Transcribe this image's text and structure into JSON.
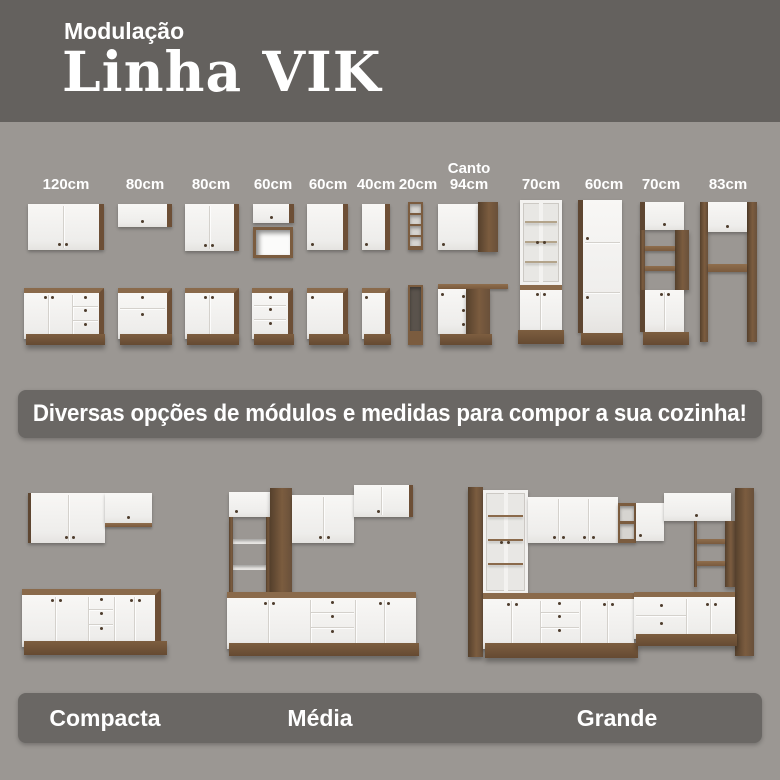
{
  "header": {
    "kicker": "Modulação",
    "title": "Linha VIK"
  },
  "modules": {
    "labels": [
      "120cm",
      "80cm",
      "80cm",
      "60cm",
      "60cm",
      "40cm",
      "20cm",
      "Canto 94cm",
      "70cm",
      "60cm",
      "70cm",
      "83cm"
    ]
  },
  "banner": {
    "text": "Diversas opções de módulos e medidas para compor a sua cozinha!"
  },
  "kitchens": {
    "labels": [
      "Compacta",
      "Média",
      "Grande"
    ]
  },
  "colors": {
    "header_bg": "#64615e",
    "page_bg": "#9b9793",
    "band_bg": "#6a6764",
    "wood": "#8a6a4b",
    "wood_dark": "#6d4f36",
    "wood_side": "#5e4631",
    "cabinet_white": "#f5f4f2",
    "text": "#ffffff"
  }
}
